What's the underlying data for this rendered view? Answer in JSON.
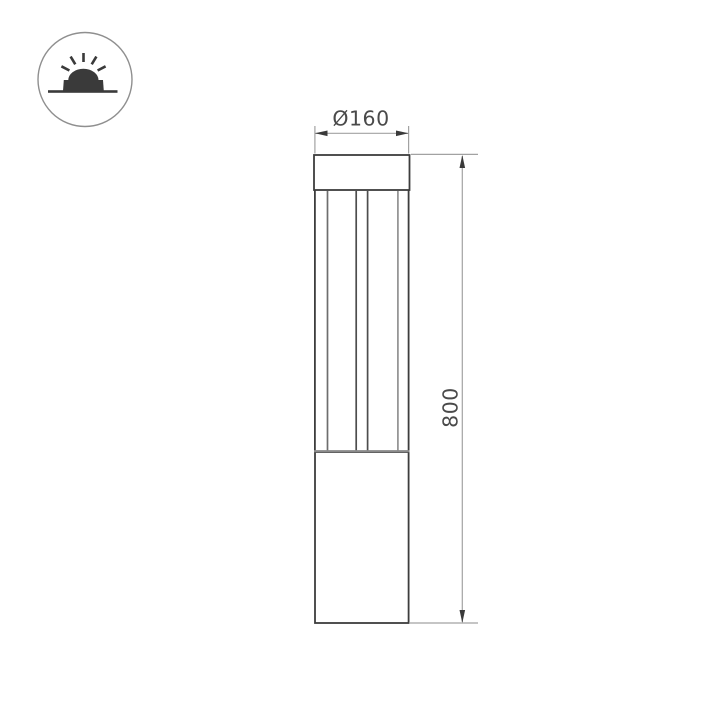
{
  "drawing": {
    "type": "technical-dimension-drawing",
    "subject": "bollard luminaire elevation view",
    "dimensions": {
      "diameter_label": "Ø160",
      "height_label": "800"
    }
  },
  "icon_badge": {
    "symbol": "ground-uplight",
    "description": "circular badge with surface-mounted luminaire emitting light upward"
  },
  "colors": {
    "background": "#ffffff",
    "outline": "#3d3d3d",
    "inner_line": "#6e6e6e",
    "inner_line_light": "#919191",
    "junction_line": "#8a8a8a",
    "dimension_line": "#a2a2a2",
    "arrow": "#3a3a3a",
    "text": "#4a4a4a",
    "icon_circle": "#8f8f8f",
    "icon_glyph": "#3a3a3a"
  }
}
